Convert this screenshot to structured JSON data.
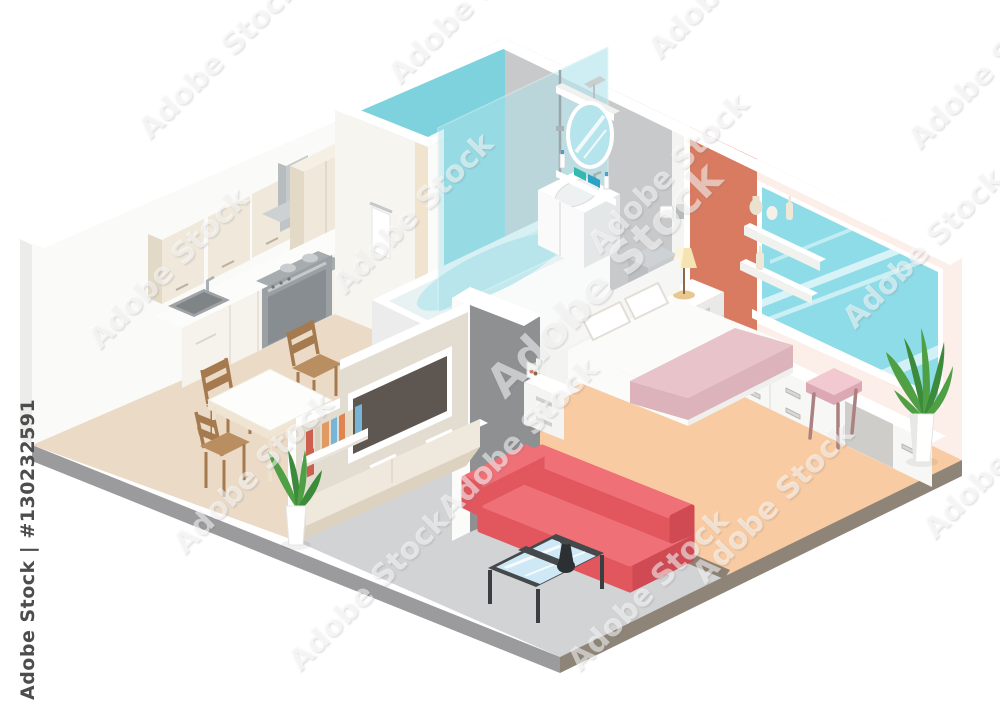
{
  "watermark": {
    "tile_text": "Adobe Stock",
    "credit_text": "Adobe Stock | #130232591"
  },
  "palette": {
    "bg": "#ffffff",
    "wall_white": "#fafaf8",
    "wall_side": "#ececea",
    "wall_teal": "#7ed2dd",
    "shower_glass": "#aee3ea",
    "wall_gray": "#c8c9cb",
    "wall_coral": "#d87b60",
    "wall_pink": "#fceee8",
    "window_glass": "#8edce8",
    "floor_kitchen": "#eadac6",
    "floor_bath": "#f3f4f2",
    "floor_bedroom": "#f8cba2",
    "floor_living": "#d2d3d5",
    "plinth_front": "#9b9b9d",
    "plinth_right": "#8e8578",
    "cabinet_cream": "#f0e8da",
    "cabinet_side": "#e2d9c6",
    "counter": "#fcfcfb",
    "counter_front": "#f6f3ed",
    "appliance": "#9aa0a4",
    "appliance_dark": "#878d91",
    "hood": "#cdd1d3",
    "steel": "#b9bfc2",
    "partition": "#e3dcd0",
    "sideboard": "#efe9dd",
    "wood": "#b98e60",
    "wood_dark": "#a57a4e",
    "sofa_top": "#ef7077",
    "sofa_front": "#e2565e",
    "sofa_dark": "#cf4a53",
    "table_frame": "#45494b",
    "table_glass": "#cfe8f5",
    "blanket": "#e8c3c9",
    "blanket_side": "#dcb3ba",
    "stool": "#f2c9d0",
    "stool_side": "#dba8b4",
    "stool_leg": "#ab8181",
    "plant": "#4f9f45",
    "plant_dark": "#3c8b3c",
    "lamp_shade": "#f6e3b2",
    "lamp_base": "#e8c88e",
    "bed_white": "#fbfbfa",
    "tv_screen": "#5e5751",
    "book_1": "#cc5f4d",
    "book_2": "#e09a62",
    "book_3": "#e6ddc8",
    "book_4": "#76b5d6",
    "book_5": "#d8d0ba",
    "book_6": "#e08552",
    "box_teal": "#35b8ad",
    "box_blue": "#2ba3c4",
    "tub_water": "#c2e9ee",
    "mirror_glass": "#b5e4ec",
    "watermark_ink": "#4d4d4d"
  }
}
